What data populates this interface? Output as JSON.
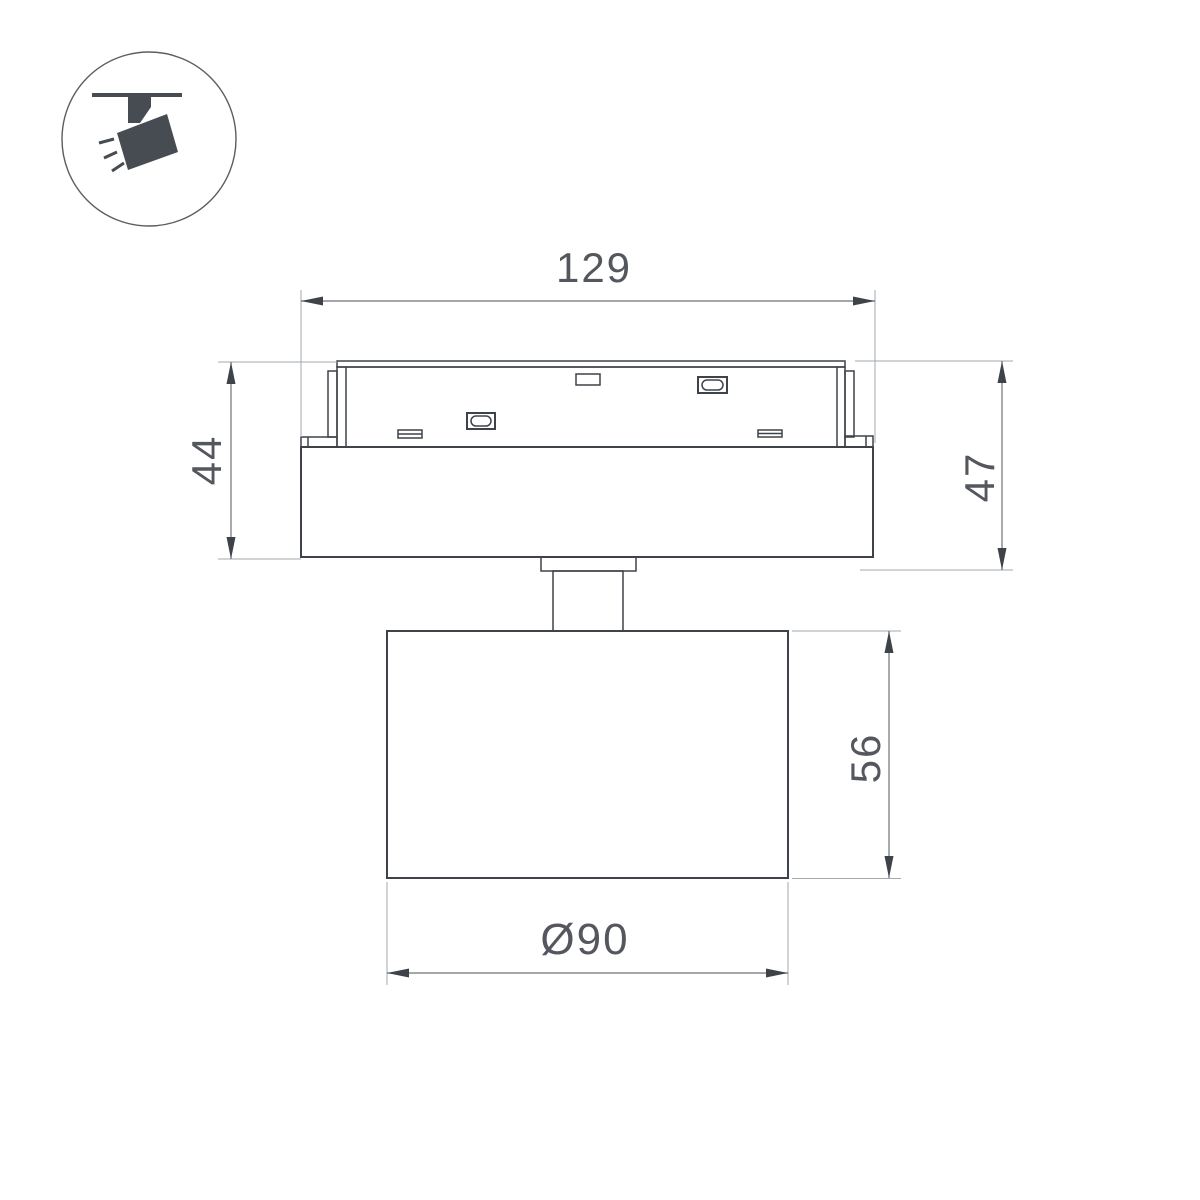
{
  "colors": {
    "part_line": "#3e4349",
    "dimension_line": "#6d7278",
    "extension_line": "#a3a8ad",
    "arrow_fill": "#3e4349",
    "text": "#54585e",
    "icon_fill": "#474c52",
    "background": "#ffffff"
  },
  "icon": {
    "name": "ceiling-track-spotlight"
  },
  "dimensions": {
    "overall_width": "129",
    "adapter_body_height": "44",
    "base_total_height": "47",
    "head_height": "56",
    "head_diameter": "Ø90"
  }
}
